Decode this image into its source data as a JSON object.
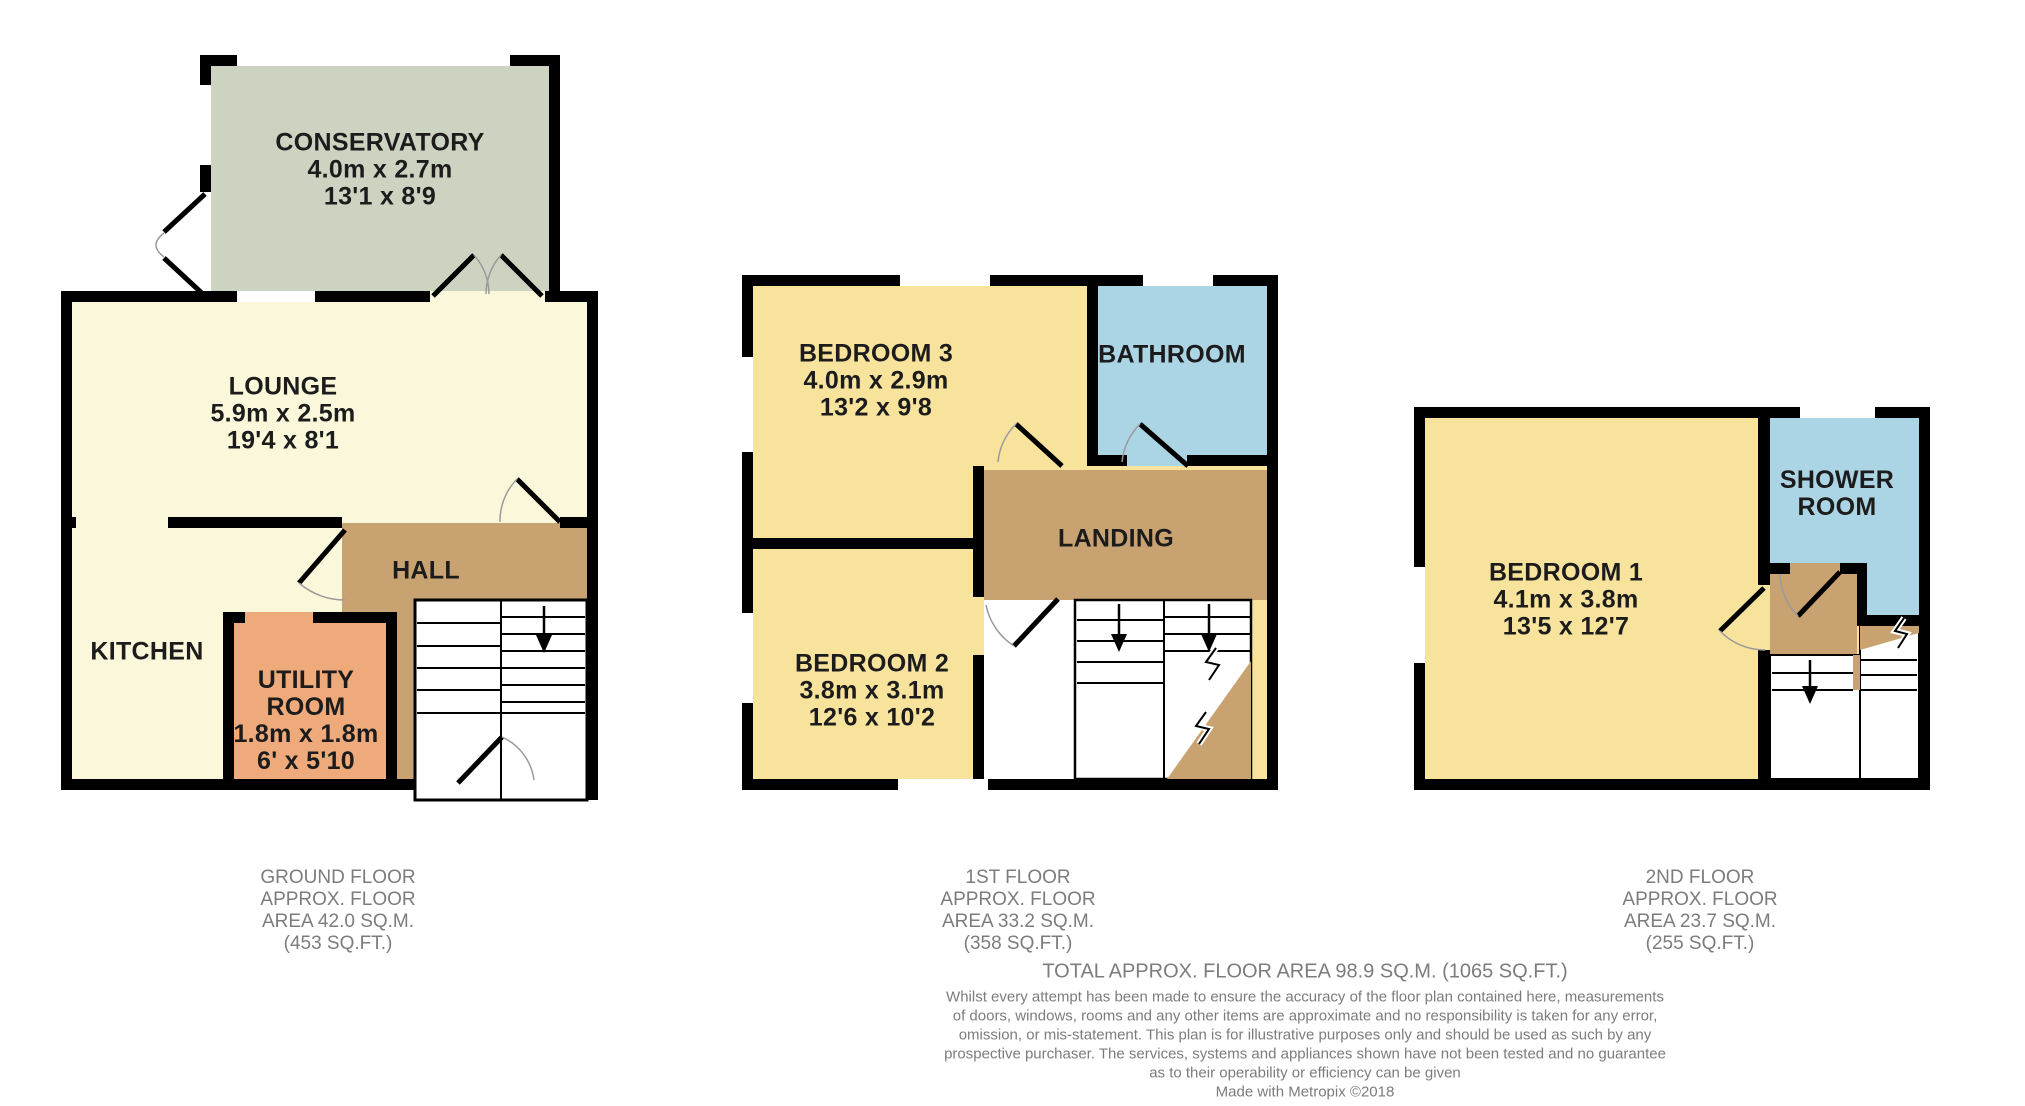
{
  "colors": {
    "wall": "#000000",
    "conservatory": "#ccd3c1",
    "cream": "#fbf7da",
    "bedroom_yellow": "#f8e39d",
    "bathroom_blue": "#abd4e5",
    "utility_orange": "#eeaa7a",
    "hall_brown": "#c8a270",
    "label_text": "#1c1c1c",
    "caption_text": "#7c7c7c",
    "door_arc": "#9a9a9a"
  },
  "floors": [
    {
      "id": "ground-floor",
      "rooms": [
        {
          "name": "conservatory",
          "lines": [
            "CONSERVATORY",
            "4.0m x 2.7m",
            "13'1 x 8'9"
          ]
        },
        {
          "name": "lounge",
          "lines": [
            "LOUNGE",
            "5.9m x 2.5m",
            "19'4 x 8'1"
          ]
        },
        {
          "name": "hall",
          "lines": [
            "HALL"
          ]
        },
        {
          "name": "kitchen",
          "lines": [
            "KITCHEN"
          ]
        },
        {
          "name": "utility-room",
          "lines": [
            "UTILITY",
            "ROOM",
            "1.8m x 1.8m",
            "6' x 5'10"
          ]
        }
      ],
      "caption": [
        "GROUND FLOOR",
        "APPROX. FLOOR",
        "AREA 42.0 SQ.M.",
        "(453 SQ.FT.)"
      ]
    },
    {
      "id": "first-floor",
      "rooms": [
        {
          "name": "bedroom-3",
          "lines": [
            "BEDROOM 3",
            "4.0m x 2.9m",
            "13'2 x 9'8"
          ]
        },
        {
          "name": "bathroom",
          "lines": [
            "BATHROOM"
          ]
        },
        {
          "name": "landing",
          "lines": [
            "LANDING"
          ]
        },
        {
          "name": "bedroom-2",
          "lines": [
            "BEDROOM 2",
            "3.8m x 3.1m",
            "12'6 x 10'2"
          ]
        }
      ],
      "caption": [
        "1ST FLOOR",
        "APPROX. FLOOR",
        "AREA 33.2 SQ.M.",
        "(358 SQ.FT.)"
      ]
    },
    {
      "id": "second-floor",
      "rooms": [
        {
          "name": "bedroom-1",
          "lines": [
            "BEDROOM 1",
            "4.1m x 3.8m",
            "13'5 x 12'7"
          ]
        },
        {
          "name": "shower-room",
          "lines": [
            "SHOWER",
            "ROOM"
          ]
        }
      ],
      "caption": [
        "2ND FLOOR",
        "APPROX. FLOOR",
        "AREA 23.7 SQ.M.",
        "(255 SQ.FT.)"
      ]
    }
  ],
  "footer": {
    "total": "TOTAL APPROX. FLOOR AREA 98.9 SQ.M. (1065 SQ.FT.)",
    "disclaimer": [
      "Whilst every attempt has been made to ensure the accuracy of the floor plan contained here, measurements",
      "of doors, windows, rooms and any other items are approximate and no responsibility is taken for any error,",
      "omission, or mis-statement. This plan is for illustrative purposes only and should be used as such by any",
      "prospective purchaser. The services, systems and appliances shown have not been tested and no guarantee",
      "as to their operability or efficiency can be given"
    ],
    "credit": "Made with Metropix ©2018"
  }
}
